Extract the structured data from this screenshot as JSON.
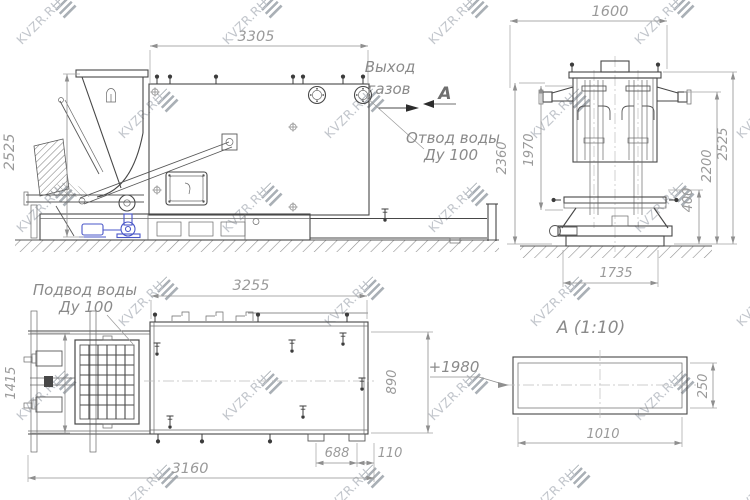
{
  "watermark": {
    "text": "KVZR.RU"
  },
  "annotations": {
    "gas_outlet_line1": "Выход",
    "gas_outlet_line2": "газов",
    "section_arrow_label": "А",
    "water_drain_line1": "Отвод воды",
    "water_drain_line2": "Ду 100",
    "water_supply_line1": "Подвод воды",
    "water_supply_line2": "Ду 100",
    "detail_title": "А (1:10)",
    "elevation_mark": "+1980"
  },
  "dimensions": {
    "side_view": {
      "width_top": "3305",
      "height_left": "2525"
    },
    "front_view": {
      "width_top": "1600",
      "height_outer_left": "2360",
      "height_inner_left": "1970",
      "height_base_right": "400",
      "height_mid_right": "2200",
      "height_outer_right": "2525",
      "width_bottom": "1735"
    },
    "top_view": {
      "width_top": "3255",
      "height_left": "1415",
      "height_right": "890",
      "width_bottom": "3160",
      "foot_span": "688",
      "edge_offset": "110"
    },
    "detail_view": {
      "width_bottom": "1010",
      "height_right": "250"
    }
  }
}
